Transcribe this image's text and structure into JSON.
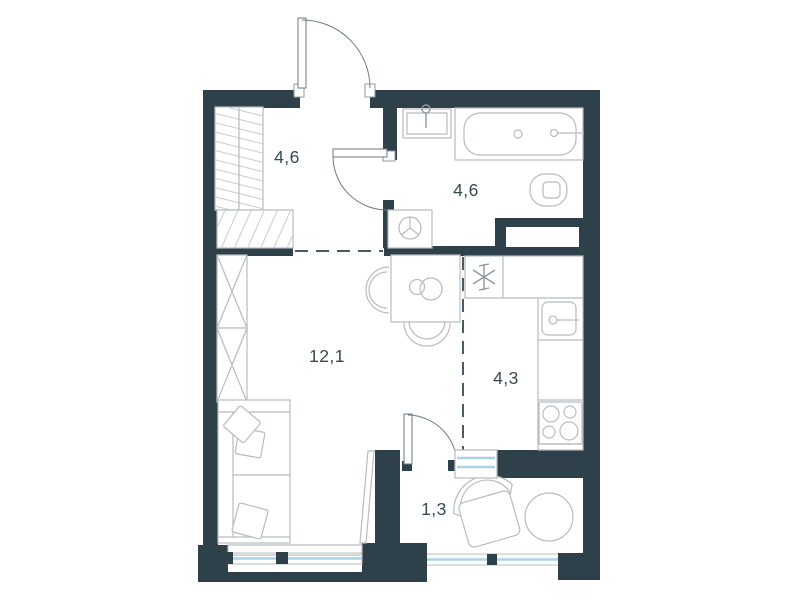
{
  "plan_title": "studio-apartment-floor-plan",
  "colors": {
    "wall": "#2e4049",
    "fixture_line": "#b6bcbf",
    "door_line": "#6b7a82",
    "glass": "#a9d3e9",
    "label_text": "#39494f",
    "zone_dash": "#4a5a62",
    "background": "#ffffff"
  },
  "rooms": {
    "hallway": {
      "name": "hallway",
      "area": "4,6"
    },
    "bathroom": {
      "name": "bathroom",
      "area": "4,6"
    },
    "living_room": {
      "name": "living-room",
      "area": "12,1"
    },
    "kitchen": {
      "name": "kitchen",
      "area": "4,3"
    },
    "balcony": {
      "name": "balcony",
      "area": "1,3"
    }
  },
  "fixtures": {
    "hallway": [
      "wardrobe-hatched",
      "entry-mat",
      "entrance-door"
    ],
    "bathroom": [
      "washbasin",
      "bathtub",
      "toilet",
      "washing-machine",
      "bathroom-door",
      "ventilation-shaft"
    ],
    "kitchen": [
      "counter",
      "asterisk-marker",
      "kitchen-sink",
      "stove"
    ],
    "living_room": [
      "closet-x",
      "sofa",
      "pillows",
      "dining-table",
      "chair",
      "chair",
      "window"
    ],
    "balcony": [
      "armchair",
      "round-table",
      "balcony-door",
      "window"
    ]
  }
}
